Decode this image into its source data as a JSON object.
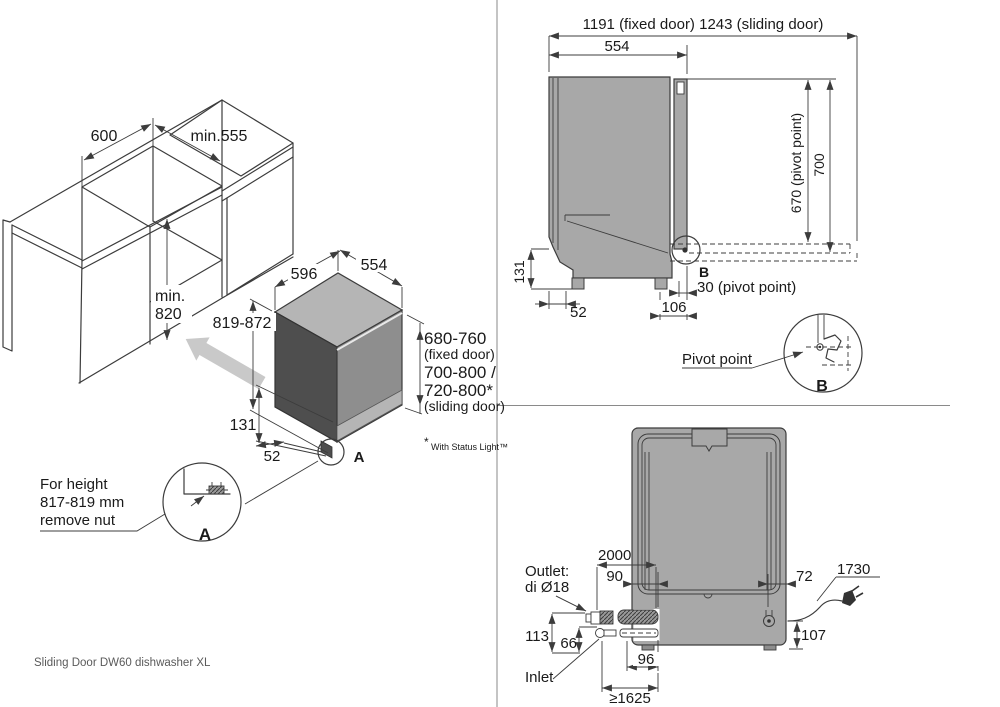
{
  "meta": {
    "footer": "Sliding Door DW60 dishwasher XL"
  },
  "iso": {
    "niche_width": "600",
    "niche_depth": "min.555",
    "niche_height_min": "min.",
    "niche_height_val": "820",
    "dw_width": "596",
    "dw_depth": "554",
    "dw_height": "819-872",
    "plinth_height": "131",
    "foot_inset": "52",
    "fixed_range": "680-760",
    "fixed_label": "(fixed door)",
    "sliding_range_1": "700-800 /",
    "sliding_range_2": "720-800*",
    "sliding_label": "(sliding door)",
    "footnote_star": "*",
    "footnote": "With Status Light™",
    "callout_line1": "For height",
    "callout_line2": "817-819 mm",
    "callout_line3": "remove nut",
    "detail_label": "A",
    "marker_label": "A"
  },
  "side": {
    "total_width": "1191 (fixed door) 1243 (sliding door)",
    "depth": "554",
    "pivot_height": "670 (pivot point)",
    "top_height": "700",
    "plinth_height": "131",
    "foot_inset": "52",
    "pivot_offset_back": "106",
    "pivot_offset": "30 (pivot point)",
    "marker_label": "B",
    "detail_label": "B",
    "pivot_label": "Pivot point"
  },
  "plan": {
    "hose_length": "2000",
    "drain_pos": "90",
    "cable_pos": "72",
    "cable_length": "1730",
    "outlet_height": "113",
    "inlet_height": "66",
    "stickout": "96",
    "reach": "≥1625",
    "cable_height": "107",
    "outlet_label_1": "Outlet:",
    "outlet_label_2": "di Ø18",
    "inlet_label": "Inlet"
  },
  "colors": {
    "body_gray": "#a8a8a8",
    "top_gray": "#b5b5b5",
    "dark_gray": "#4e4e4e",
    "door_gray": "#8e8e8e",
    "arrow_gray": "#c9c9c9",
    "line": "#3c3c3c"
  }
}
